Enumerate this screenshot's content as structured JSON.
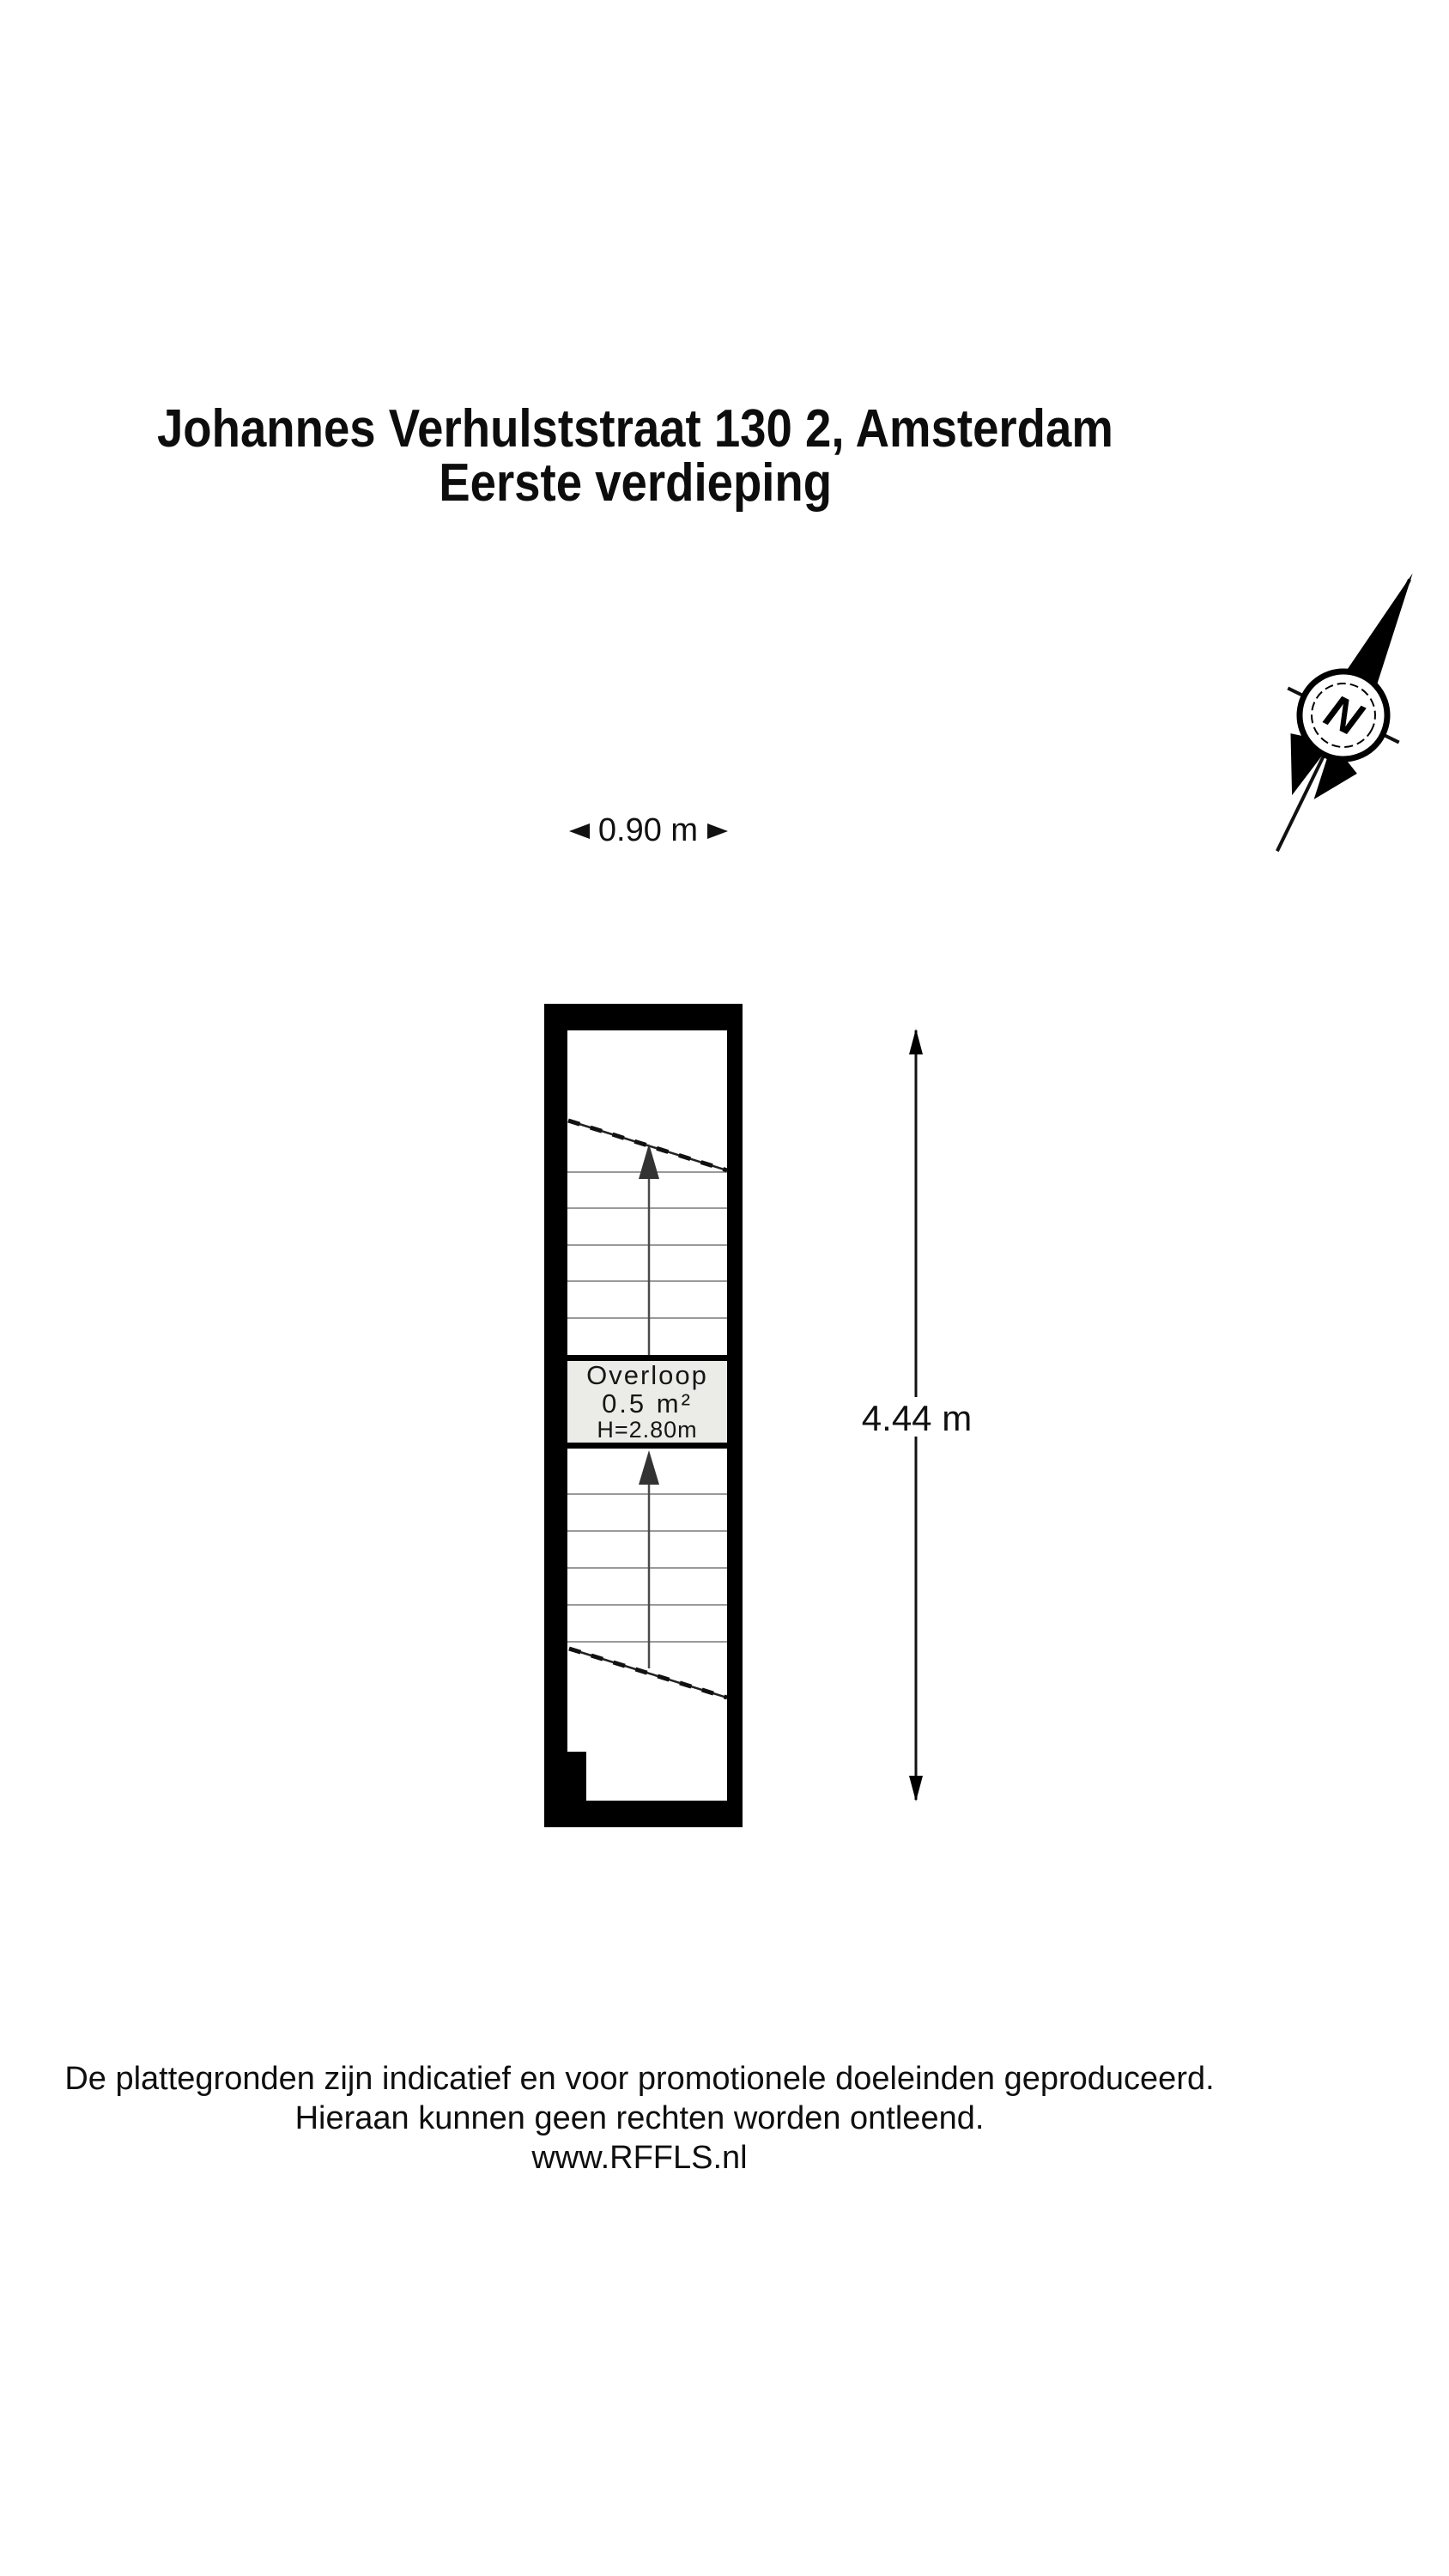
{
  "title": {
    "line1": "Johannes Verhulststraat 130 2, Amsterdam",
    "line2": "Eerste verdieping"
  },
  "compass": {
    "label": "N"
  },
  "dimensions": {
    "width": "0.90 m",
    "height": "4.44 m"
  },
  "room": {
    "name": "Overloop",
    "area": "0.5 m²",
    "height": "H=2.80m"
  },
  "footer": {
    "line1": "De plattegronden zijn indicatief en voor promotionele doeleinden geproduceerd.",
    "line2": "Hieraan kunnen geen rechten worden ontleend.",
    "line3": "www.RFFLS.nl"
  },
  "colors": {
    "walls": "#000000",
    "landing_background": "#ebebe8",
    "text": "#111111",
    "stair_lines": "#787878"
  }
}
